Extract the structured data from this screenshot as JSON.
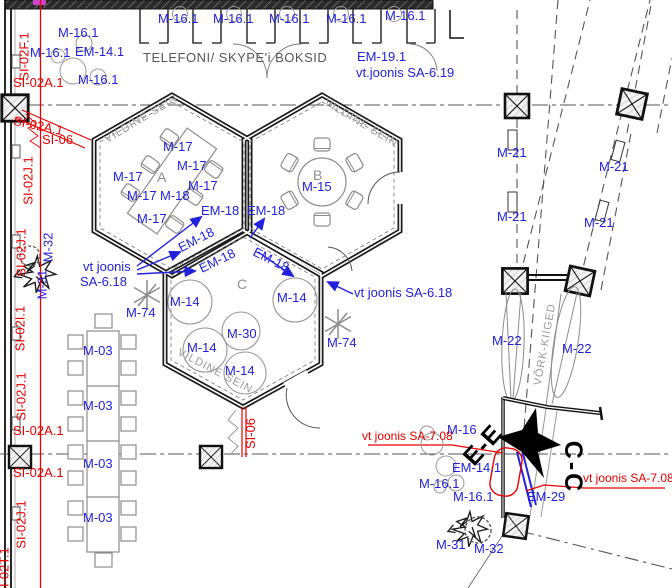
{
  "title": "Floor plan detail with hexagonal rooms and annotations",
  "colors": {
    "label_blue": "#2222dd",
    "label_red": "#ea0000",
    "wall": "#111111",
    "furniture_gray": "#8c8c8c",
    "text_gray": "#969696"
  },
  "codes": {
    "m16_1": "M-16.1",
    "em14_1": "EM-14.1",
    "em19_1": "EM-19.1",
    "m17": "M-17",
    "m18": "M-18",
    "m15": "M-15",
    "em18": "EM-18",
    "m14": "M-14",
    "m30": "M-30",
    "m74": "M-74",
    "m03": "M-03",
    "m21": "M-21",
    "m22": "M-22",
    "m16": "M-16",
    "em29": "EM-29",
    "m31": "M-31",
    "m32": "M-32"
  },
  "red_codes": {
    "si02f1": "SI-02F.1",
    "si02a1": "SI-02A.1",
    "si02j1": "SI-02J.1",
    "si02i1": "SI-02I.1",
    "si02t1": "SI-02T.1",
    "si06": "SI-06"
  },
  "notes": {
    "booths_caption": "TELEFONI/ SKYPE'i BOKSID",
    "see_sa619": "vt.joonis SA-6.19",
    "see_sa618": "vt joonis SA-6.18",
    "see_sa618_l1": "vt joonis",
    "see_sa618_l2": "SA-6.18",
    "see_sa708": "vt joonis SA-7.08"
  },
  "wall_labels": {
    "vildine": "VILDINE SEIN",
    "vork": "VÕRK-KIIGED"
  },
  "rooms": {
    "a": "A",
    "b": "B",
    "c": "C"
  },
  "sections": {
    "ee": "E-E",
    "cc": "C-C"
  }
}
